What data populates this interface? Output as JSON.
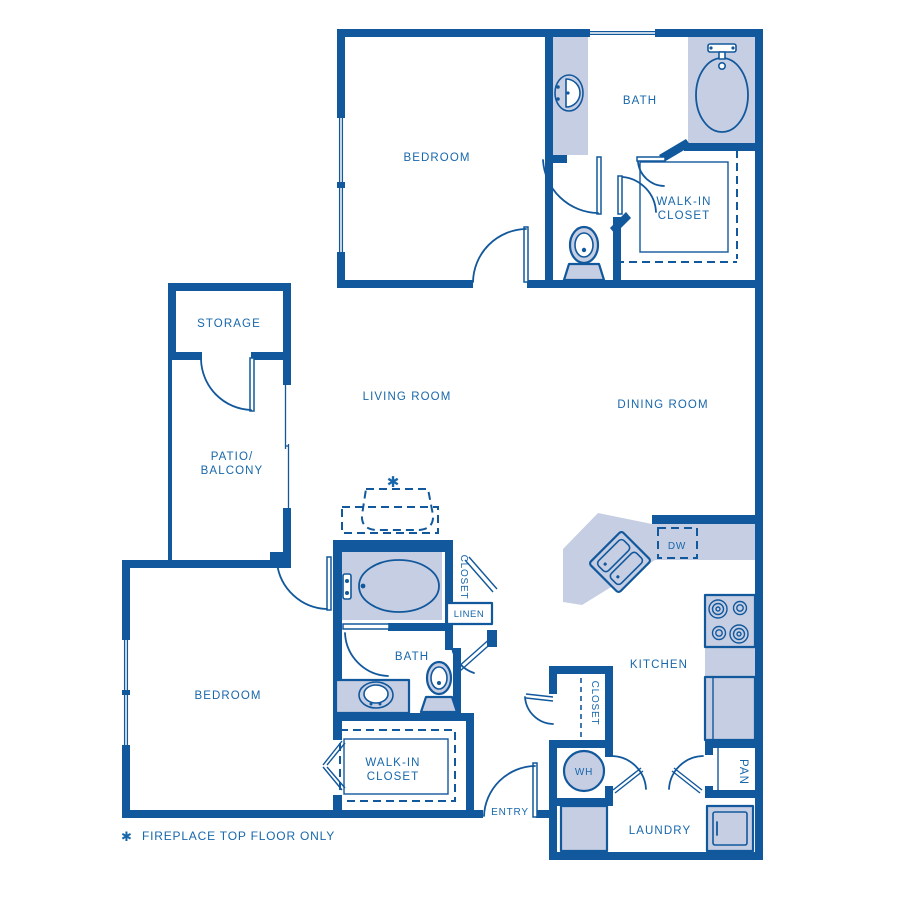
{
  "meta": {
    "kind": "apartment-floor-plan",
    "style": "blueprint-blue-on-white"
  },
  "colors": {
    "wall": "#12589c",
    "fill": "#c6cee3",
    "text": "#1767ab",
    "white": "#ffffff"
  },
  "rooms": {
    "bedroom_upper": "BEDROOM",
    "bath_upper": "BATH",
    "wic_upper_l1": "WALK-IN",
    "wic_upper_l2": "CLOSET",
    "storage": "STORAGE",
    "living": "LIVING ROOM",
    "dining": "DINING ROOM",
    "patio_l1": "PATIO/",
    "patio_l2": "BALCONY",
    "closet_bath": "CLOSET",
    "linen": "LINEN",
    "bath_lower": "BATH",
    "bedroom_lower": "BEDROOM",
    "wic_lower_l1": "WALK-IN",
    "wic_lower_l2": "CLOSET",
    "entry": "ENTRY",
    "kitchen": "KITCHEN",
    "dw": "DW",
    "closet_hall": "CLOSET",
    "wh": "WH",
    "pan": "PAN",
    "laundry": "LAUNDRY"
  },
  "annotations": {
    "fireplace_star": "✱",
    "footnote_star": "✱",
    "footnote": "FIREPLACE TOP FLOOR ONLY"
  },
  "fixtures": [
    "bathtub-upper",
    "vanity-sink-upper",
    "toilet-upper",
    "bathtub-lower",
    "vanity-sink-lower",
    "toilet-lower",
    "kitchen-double-sink",
    "dishwasher",
    "stove-4-burners",
    "refrigerator",
    "water-heater",
    "washer",
    "dryer",
    "fireplace-dashed"
  ]
}
